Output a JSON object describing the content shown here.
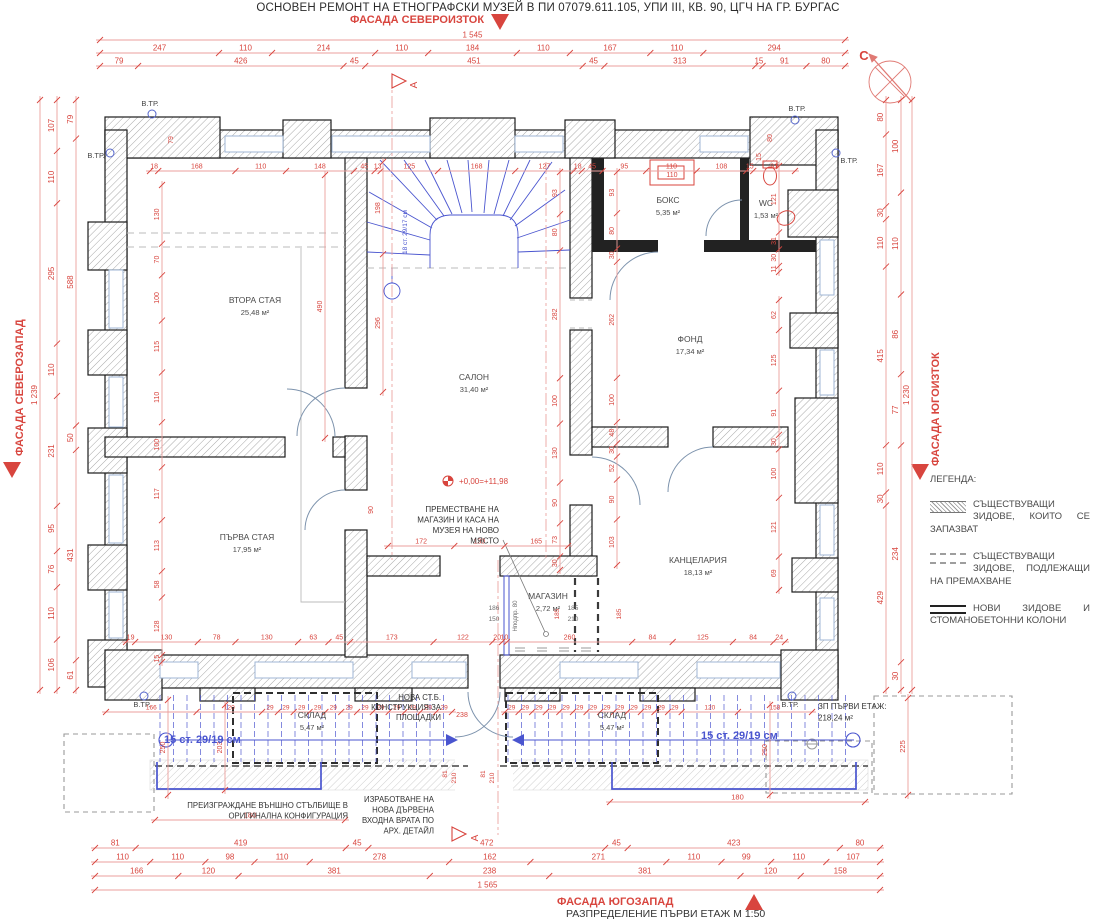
{
  "title": "ОСНОВЕН РЕМОНТ НА ЕТНОГРАФСКИ МУЗЕЙ В ПИ 07079.611.105, УПИ III, КВ. 90, ЦГЧ НА ГР. БУРГАС",
  "plan_title": "РАЗПРЕДЕЛЕНИЕ ПЪРВИ ЕТАЖ  М 1:50",
  "facades": {
    "top": "ФАСАДА СЕВЕРОИЗТОК",
    "left": "ФАСАДА СЕВЕРОЗАПАД",
    "right": "ФАСАДА ЮГОИЗТОК",
    "bottom": "ФАСАДА ЮГОЗАПАД"
  },
  "north": "С",
  "legend": {
    "heading": "ЛЕГЕНДА:",
    "items": [
      {
        "swatch": "hatch",
        "text": "СЪЩЕСТВУВАЩИ ЗИДОВЕ, КОИТО СЕ ЗАПАЗВАТ"
      },
      {
        "swatch": "dashed",
        "text": "СЪЩЕСТВУВАЩИ ЗИДОВЕ, ПОДЛЕЖАЩИ НА ПРЕМАХВАНЕ"
      },
      {
        "swatch": "solid",
        "text": "НОВИ ЗИДОВЕ И СТОМАНОБЕТОННИ КОЛОНИ"
      }
    ]
  },
  "rooms": [
    {
      "n": "ВТОРА СТАЯ",
      "a": "25,48 м²",
      "x": 255,
      "y": 303
    },
    {
      "n": "САЛОН",
      "a": "31,40 м²",
      "x": 474,
      "y": 380
    },
    {
      "n": "ФОНД",
      "a": "17,34 м²",
      "x": 690,
      "y": 342
    },
    {
      "n": "ПЪРВА СТАЯ",
      "a": "17,95 м²",
      "x": 247,
      "y": 540
    },
    {
      "n": "КАНЦЕЛАРИЯ",
      "a": "18,13 м²",
      "x": 698,
      "y": 563
    },
    {
      "n": "МАГАЗИН",
      "a": "2,72 м²",
      "x": 548,
      "y": 599
    },
    {
      "n": "БОКС",
      "a": "5,35 м²",
      "x": 668,
      "y": 203
    },
    {
      "n": "WC",
      "a": "1,53 м²",
      "x": 766,
      "y": 206
    },
    {
      "n": "СКЛАД",
      "a": "5,47 м²",
      "x": 312,
      "y": 718
    },
    {
      "n": "СКЛАД",
      "a": "5,47 м²",
      "x": 612,
      "y": 718
    }
  ],
  "vtr": {
    "label": "В.ТР.",
    "positions": [
      {
        "x": 150,
        "y": 106,
        "cx": 152,
        "cy": 114
      },
      {
        "x": 96,
        "y": 158,
        "cx": 110,
        "cy": 153
      },
      {
        "x": 797,
        "y": 111,
        "cx": 795,
        "cy": 120
      },
      {
        "x": 849,
        "y": 163,
        "cx": 836,
        "cy": 153
      },
      {
        "x": 142,
        "y": 707,
        "cx": 144,
        "cy": 696
      },
      {
        "x": 790,
        "y": 707,
        "cx": 792,
        "cy": 696
      }
    ]
  },
  "dims": {
    "h": [
      {
        "y": 40,
        "x1": 100,
        "x2": 845,
        "v": [
          "1 545"
        ],
        "fs": 8
      },
      {
        "y": 53,
        "x1": 100,
        "x2": 845,
        "v": [
          247,
          110,
          214,
          110,
          184,
          110,
          167,
          110,
          294
        ],
        "fs": 8
      },
      {
        "y": 66,
        "x1": 100,
        "x2": 845,
        "v": [
          79,
          426,
          45,
          451,
          45,
          313,
          15,
          91,
          80
        ],
        "fs": 8
      },
      {
        "y": 848,
        "x1": 95,
        "x2": 880,
        "v": [
          81,
          419,
          45,
          472,
          45,
          423,
          80
        ],
        "fs": 8
      },
      {
        "y": 862,
        "x1": 95,
        "x2": 880,
        "v": [
          110,
          110,
          98,
          110,
          278,
          162,
          271,
          110,
          99,
          110,
          107
        ],
        "fs": 8
      },
      {
        "y": 876,
        "x1": 95,
        "x2": 880,
        "v": [
          166,
          120,
          381,
          238,
          381,
          120,
          158
        ],
        "fs": 8
      },
      {
        "y": 890,
        "x1": 95,
        "x2": 880,
        "v": [
          "1 565"
        ],
        "fs": 8
      },
      {
        "y": 171,
        "x1": 150,
        "x2": 795,
        "v": [
          18,
          168,
          110,
          148,
          45,
          13,
          125,
          168,
          127,
          18,
          45,
          95,
          110,
          108,
          15,
          91
        ],
        "fs": 7
      },
      {
        "y": 642,
        "x1": 126,
        "x2": 785,
        "v": [
          19,
          130,
          78,
          130,
          63,
          45,
          173,
          122,
          20,
          10,
          260,
          84,
          125,
          84,
          24
        ],
        "fs": 7
      },
      {
        "y": 546,
        "x1": 388,
        "x2": 568,
        "v": [
          172,
          130,
          165
        ],
        "fs": 7
      },
      {
        "y": 712,
        "x1": 106,
        "x2": 452,
        "v": [
          166,
          120,
          29,
          29,
          29,
          29,
          29,
          29,
          29,
          29,
          29,
          29,
          29,
          29
        ],
        "fs": 6.5
      },
      {
        "y": 712,
        "x1": 505,
        "x2": 812,
        "v": [
          29,
          29,
          29,
          29,
          29,
          29,
          29,
          29,
          29,
          29,
          29,
          29,
          29,
          120,
          158
        ],
        "fs": 6.5
      },
      {
        "y": 820,
        "x1": 155,
        "x2": 345,
        "v": [
          180
        ],
        "fs": 7.5
      },
      {
        "y": 802,
        "x1": 610,
        "x2": 865,
        "v": [
          180
        ],
        "fs": 7.5
      }
    ],
    "v": [
      {
        "x": 40,
        "y1": 100,
        "y2": 690,
        "v": [
          "1 239"
        ],
        "fs": 8
      },
      {
        "x": 57,
        "y1": 100,
        "y2": 690,
        "v": [
          107,
          110,
          295,
          110,
          231,
          95,
          76,
          110,
          106
        ],
        "fs": 8
      },
      {
        "x": 76,
        "y1": 100,
        "y2": 690,
        "v": [
          79,
          588,
          50,
          431,
          61
        ],
        "fs": 8
      },
      {
        "x": 886,
        "y1": 100,
        "y2": 690,
        "v": [
          80,
          167,
          30,
          110,
          415,
          110,
          30,
          429
        ],
        "fs": 8
      },
      {
        "x": 901,
        "y1": 100,
        "y2": 690,
        "v": [
          100,
          110,
          86,
          77,
          234,
          30
        ],
        "fs": 8
      },
      {
        "x": 912,
        "y1": 100,
        "y2": 690,
        "v": [
          "1 230"
        ],
        "fs": 8
      },
      {
        "x": 162,
        "y1": 185,
        "y2": 662,
        "v": [
          130,
          70,
          100,
          115,
          110,
          100,
          117,
          113,
          58,
          128,
          15
        ],
        "fs": 7
      },
      {
        "x": 325,
        "y1": 175,
        "y2": 438,
        "v": [
          490
        ],
        "fs": 7
      },
      {
        "x": 383,
        "y1": 162,
        "y2": 392,
        "v": [
          198,
          296
        ],
        "fs": 7
      },
      {
        "x": 560,
        "y1": 172,
        "y2": 570,
        "v": [
          93,
          80,
          282,
          100,
          130,
          90,
          73,
          30
        ],
        "fs": 7
      },
      {
        "x": 617,
        "y1": 172,
        "y2": 565,
        "v": [
          93,
          80,
          30,
          262,
          100,
          48,
          30,
          52,
          90,
          103
        ],
        "fs": 7
      },
      {
        "x": 779,
        "y1": 166,
        "y2": 272,
        "v": [
          121,
          31,
          30,
          11
        ],
        "fs": 7
      },
      {
        "x": 779,
        "y1": 300,
        "y2": 590,
        "v": [
          62,
          125,
          91,
          30,
          100,
          121,
          69
        ],
        "fs": 7
      },
      {
        "x": 168,
        "y1": 700,
        "y2": 795,
        "v": [
          250
        ],
        "fs": 7
      },
      {
        "x": 225,
        "y1": 705,
        "y2": 790,
        "v": [
          203
        ],
        "fs": 7
      },
      {
        "x": 770,
        "y1": 705,
        "y2": 795,
        "v": [
          250
        ],
        "fs": 7
      },
      {
        "x": 908,
        "y1": 698,
        "y2": 795,
        "v": [
          225
        ],
        "fs": 7.5
      }
    ]
  },
  "labels": [
    {
      "t": "+0,00=+11,98",
      "x": 459,
      "y": 484,
      "s": 8,
      "c": "red",
      "a": "start"
    },
    {
      "t": "С",
      "x": 864,
      "y": 60,
      "s": 13,
      "c": "red",
      "b": 1
    },
    {
      "t": "А",
      "x": 417,
      "y": 85,
      "s": 10,
      "c": "red",
      "r": 1
    },
    {
      "t": "А",
      "x": 478,
      "y": 838,
      "s": 10,
      "c": "red",
      "r": 1
    },
    {
      "t": "110",
      "x": 672,
      "y": 177,
      "s": 7,
      "c": "red"
    },
    {
      "t": "79",
      "x": 173,
      "y": 140,
      "s": 7,
      "c": "red",
      "r": 1
    },
    {
      "t": "80",
      "x": 772,
      "y": 138,
      "s": 7,
      "c": "red",
      "r": 1
    },
    {
      "t": "15",
      "x": 761,
      "y": 157,
      "s": 7,
      "c": "red",
      "r": 1
    },
    {
      "t": "81",
      "x": 447,
      "y": 774,
      "s": 6.5,
      "c": "red",
      "r": 1
    },
    {
      "t": "210",
      "x": 456,
      "y": 778,
      "s": 6.5,
      "c": "red",
      "r": 1
    },
    {
      "t": "81",
      "x": 485,
      "y": 774,
      "s": 6.5,
      "c": "red",
      "r": 1
    },
    {
      "t": "210",
      "x": 494,
      "y": 778,
      "s": 6.5,
      "c": "red",
      "r": 1
    },
    {
      "t": "238",
      "x": 462,
      "y": 717,
      "s": 7,
      "c": "red"
    },
    {
      "t": "90",
      "x": 373,
      "y": 510,
      "s": 7,
      "c": "red",
      "r": 1
    },
    {
      "t": "186",
      "x": 494,
      "y": 610,
      "s": 6.5,
      "c": "grey"
    },
    {
      "t": "150",
      "x": 494,
      "y": 621,
      "s": 6.5,
      "c": "grey"
    },
    {
      "t": "185",
      "x": 559,
      "y": 614,
      "s": 6.5,
      "c": "red",
      "r": 1
    },
    {
      "t": "185",
      "x": 573,
      "y": 610,
      "s": 6.5,
      "c": "grey"
    },
    {
      "t": "210",
      "x": 573,
      "y": 621,
      "s": 6.5,
      "c": "grey"
    },
    {
      "t": "185",
      "x": 621,
      "y": 614,
      "s": 6.5,
      "c": "red",
      "r": 1
    },
    {
      "t": "Нподпр. 80",
      "x": 517,
      "y": 616,
      "s": 6,
      "c": "grey",
      "r": 1
    }
  ],
  "notes": [
    {
      "t": "ПРЕМЕСТВАНЕ НА\nМАГАЗИН И КАСА НА\nМУЗЕЯ НА НОВО\nМЯСТО",
      "x": 499,
      "y": 512,
      "a": "end",
      "s": 8,
      "lh": 10.5
    },
    {
      "t": "ПРЕИЗГРАЖДАНЕ ВЪНШНО СТЪЛБИЩЕ В\nОРИГИНАЛНА КОНФИГУРАЦИЯ",
      "x": 348,
      "y": 808,
      "a": "end",
      "s": 7.8,
      "lh": 10.5
    },
    {
      "t": "ИЗРАБОТВАНЕ НА\nНОВА ДЪРВЕНА\nВХОДНА ВРАТА ПО\nАРХ. ДЕТАЙЛ",
      "x": 434,
      "y": 802,
      "a": "end",
      "s": 7.8,
      "lh": 10.5
    },
    {
      "t": "НОВА СТ.Б.\nКОНСТРУКЦИЯ ЗА\nПЛОЩАДКИ",
      "x": 441,
      "y": 700,
      "a": "end",
      "s": 7.8,
      "lh": 10
    },
    {
      "t": "ЗП ПЪРВИ ЕТАЖ:\n218,24 м²",
      "x": 818,
      "y": 709,
      "a": "start",
      "s": 8,
      "lh": 11.5
    },
    {
      "t": "15 ст. 29/19 см",
      "x": 164,
      "y": 743,
      "a": "start",
      "s": 11,
      "c": "blue",
      "b": 1
    },
    {
      "t": "15 ст. 29/19 см",
      "x": 701,
      "y": 739,
      "a": "start",
      "s": 11,
      "c": "blue",
      "b": 1
    },
    {
      "t": "18 ст. 29/17 см",
      "x": 407,
      "y": 232,
      "s": 6.5,
      "c": "blue",
      "r": 1
    }
  ],
  "colors": {
    "red": "#d8453e",
    "line_red": "#eb9f9c",
    "blue": "#4a55cf",
    "grey": "#6e6e6e",
    "black": "#333333",
    "pale_blue": "#9fb6d4",
    "wall_outline": "#1c1c1c"
  }
}
